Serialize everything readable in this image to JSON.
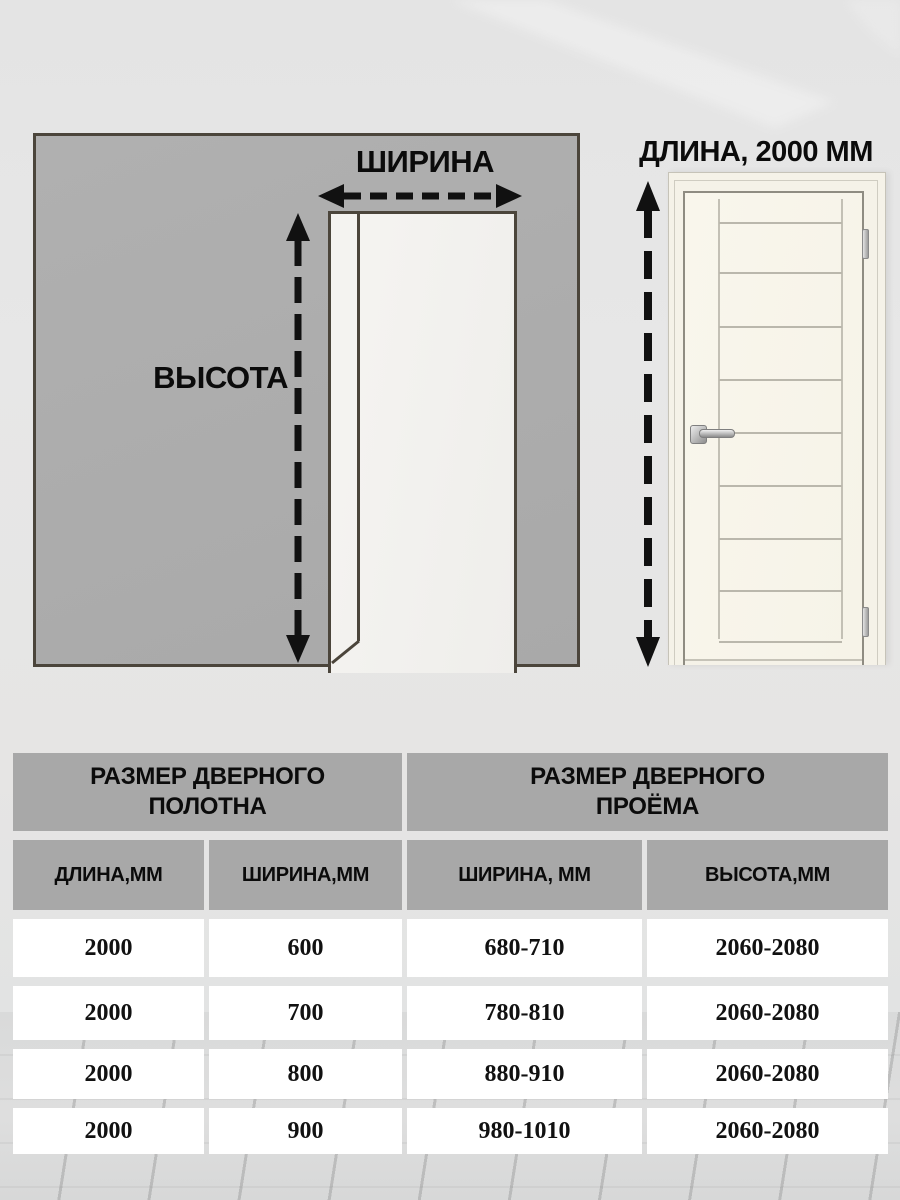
{
  "diagram": {
    "width_label": "ШИРИНА",
    "height_label": "ВЫСОТА",
    "door_length_label": "ДЛИНА, 2000 ММ"
  },
  "table": {
    "group_headers": [
      {
        "line1": "РАЗМЕР ДВЕРНОГО",
        "line2": "ПОЛОТНА"
      },
      {
        "line1": "РАЗМЕР ДВЕРНОГО",
        "line2": "ПРОЁМА"
      }
    ],
    "column_headers": [
      "ДЛИНА,ММ",
      "ШИРИНА,ММ",
      "ШИРИНА, ММ",
      "ВЫСОТА,ММ"
    ],
    "rows": [
      [
        "2000",
        "600",
        "680-710",
        "2060-2080"
      ],
      [
        "2000",
        "700",
        "780-810",
        "2060-2080"
      ],
      [
        "2000",
        "800",
        "880-910",
        "2060-2080"
      ],
      [
        "2000",
        "900",
        "980-1010",
        "2060-2080"
      ]
    ]
  },
  "colors": {
    "wall_fill": "#adadad",
    "wall_outline": "#4b453b",
    "arrow_color": "#111111",
    "table_header_bg": "#a8a8a8",
    "table_cell_bg": "#ffffff",
    "door_leaf": "#f8f5eb"
  }
}
